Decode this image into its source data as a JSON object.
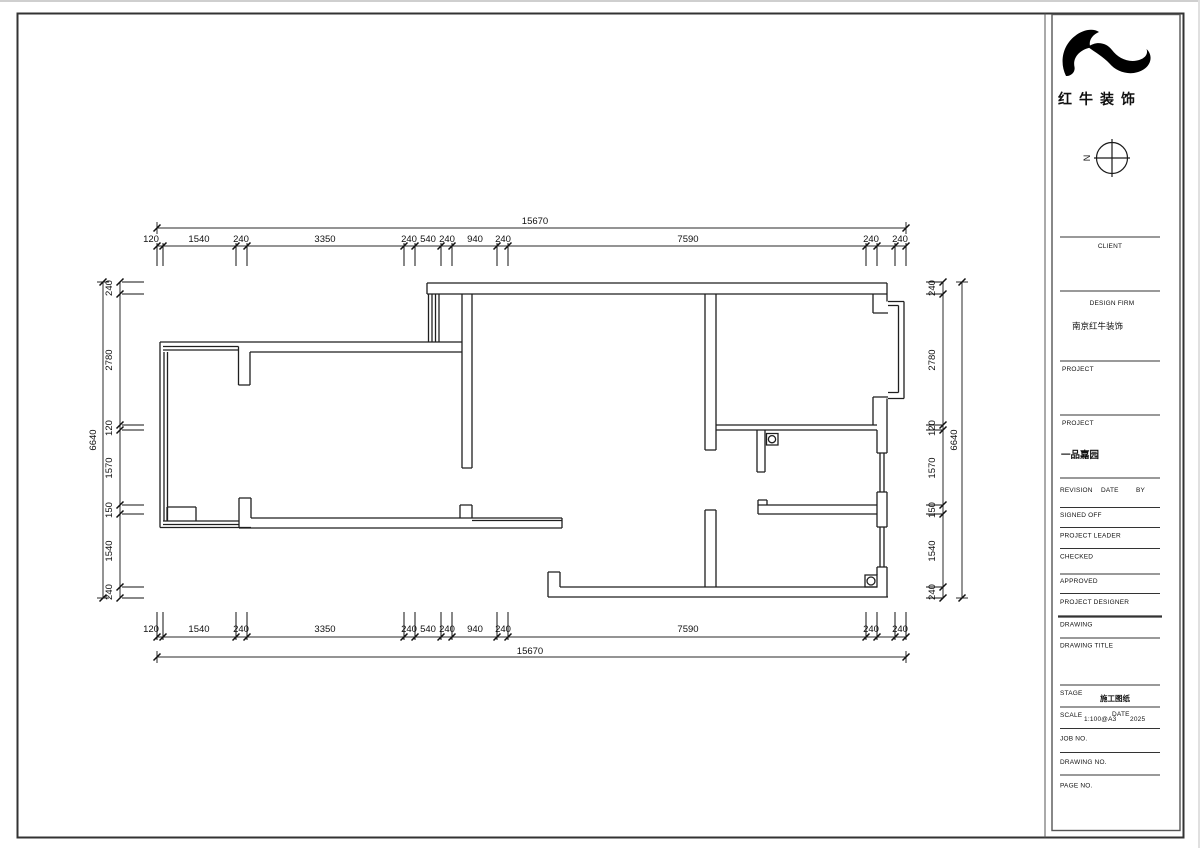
{
  "logo": {
    "company_name": "红牛装饰"
  },
  "compass": {
    "north_label": "N"
  },
  "dims": {
    "top_total": "15670",
    "bottom_total": "15670",
    "left_total": "6640",
    "right_total": "6640",
    "h_segments": [
      "120",
      "1540",
      "240",
      "3350",
      "240",
      "540",
      "240",
      "940",
      "240",
      "7590",
      "240",
      "240"
    ],
    "v_segments": [
      "240",
      "2780",
      "120",
      "1570",
      "150",
      "1540",
      "240"
    ]
  },
  "title_block": {
    "client_label": "CLIENT",
    "design_firm_label": "DESIGN FIRM",
    "design_firm_value": "南京红牛装饰",
    "project_label_1": "PROJECT",
    "project_label_2": "PROJECT",
    "project_name": "一品嘉园",
    "revision_label": "REVISION",
    "date_label": "DATE",
    "by_label": "BY",
    "signed_off_label": "SIGNED OFF",
    "project_leader_label": "PROJECT LEADER",
    "checked_label": "CHECKED",
    "approved_label": "APPROVED",
    "project_designer_label": "PROJECT DESIGNER",
    "drawing_label": "DRAWING",
    "drawing_title_label": "DRAWING TITLE",
    "stage_label": "STAGE",
    "stage_value": "施工图纸",
    "scale_label": "SCALE",
    "scale_value": "1:100@A3",
    "scale_date_label": "DATE",
    "scale_date_value": "2025",
    "job_no_label": "JOB NO.",
    "drawing_no_label": "DRAWING NO.",
    "page_no_label": "PAGE NO."
  }
}
